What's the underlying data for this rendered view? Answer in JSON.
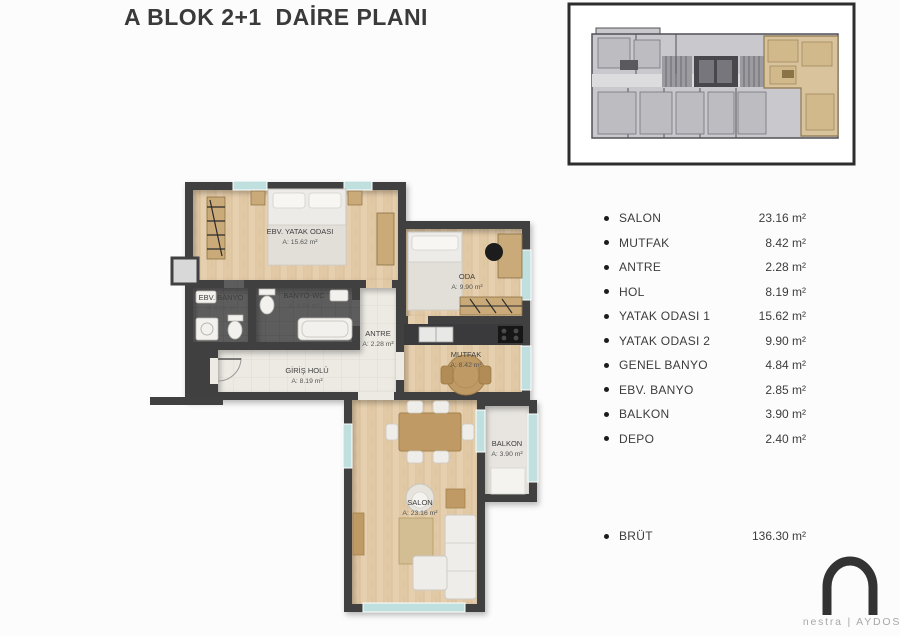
{
  "title": "A BLOK 2+1  DAİRE PLANI",
  "legend": {
    "items": [
      {
        "label": "SALON",
        "value": "23.16 m²"
      },
      {
        "label": "MUTFAK",
        "value": "8.42 m²"
      },
      {
        "label": "ANTRE",
        "value": "2.28 m²"
      },
      {
        "label": "HOL",
        "value": "8.19 m²"
      },
      {
        "label": "YATAK ODASI 1",
        "value": "15.62 m²"
      },
      {
        "label": "YATAK ODASI 2",
        "value": "9.90 m²"
      },
      {
        "label": "GENEL BANYO",
        "value": "4.84 m²"
      },
      {
        "label": "EBV. BANYO",
        "value": "2.85 m²"
      },
      {
        "label": "BALKON",
        "value": "3.90 m²"
      },
      {
        "label": "DEPO",
        "value": "2.40 m²"
      }
    ],
    "total": {
      "label": "BRÜT",
      "value": "136.30 m²"
    }
  },
  "plan": {
    "rooms": [
      {
        "name": "EBV. YATAK ODASI",
        "area": "A: 15.62 m²"
      },
      {
        "name": "ODA",
        "area": "A: 9.90 m²"
      },
      {
        "name": "EBV. BANYO",
        "area": "A: 2.85 m²"
      },
      {
        "name": "BANYO-WC",
        "area": "A: 4.84 m²"
      },
      {
        "name": "ANTRE",
        "area": "A: 2.28 m²"
      },
      {
        "name": "GİRİŞ HOLÜ",
        "area": "A: 8.19 m²"
      },
      {
        "name": "MUTFAK",
        "area": "A: 8.42 m²"
      },
      {
        "name": "SALON",
        "area": "A: 23.16 m²"
      },
      {
        "name": "BALKON",
        "area": "A: 3.90 m²"
      }
    ]
  },
  "logo": {
    "text": "nestra | AYDOS"
  },
  "colors": {
    "wall": "#414141",
    "wood_floor": "#e6cfae",
    "hall_floor": "#edeae3",
    "bath_floor": "#5d5d5d",
    "balcony_floor": "#e8e5e0",
    "window_glass": "#bfe0df",
    "unit_highlight": "#d9c39c"
  }
}
